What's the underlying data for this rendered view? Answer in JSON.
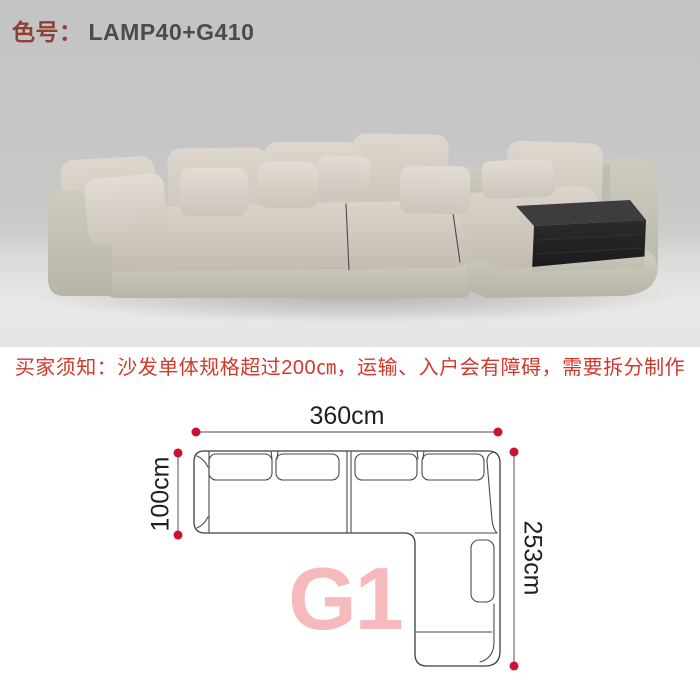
{
  "header": {
    "label": "色号：",
    "value": "LAMP40+G410"
  },
  "notice": {
    "text": "买家须知：沙发单体规格超过200㎝，运输、入户会有障碍，需要拆分制作"
  },
  "diagram": {
    "model": "G1",
    "dim_width": "360cm",
    "dim_depth": "100cm",
    "dim_length": "253cm"
  },
  "colors": {
    "notice_red": "#d0392b",
    "header_label_red": "#8f4136",
    "header_value_gray": "#4b4b4d",
    "dot_red": "#cb1134",
    "model_pink": "#f6b9bc",
    "diagram_line": "#3e3e3e",
    "photo_background": "#c8c7c5",
    "sofa_fabric": "#d8d1c8",
    "sofa_leather": "#c7c6b8",
    "storage_box_black": "#232325"
  }
}
